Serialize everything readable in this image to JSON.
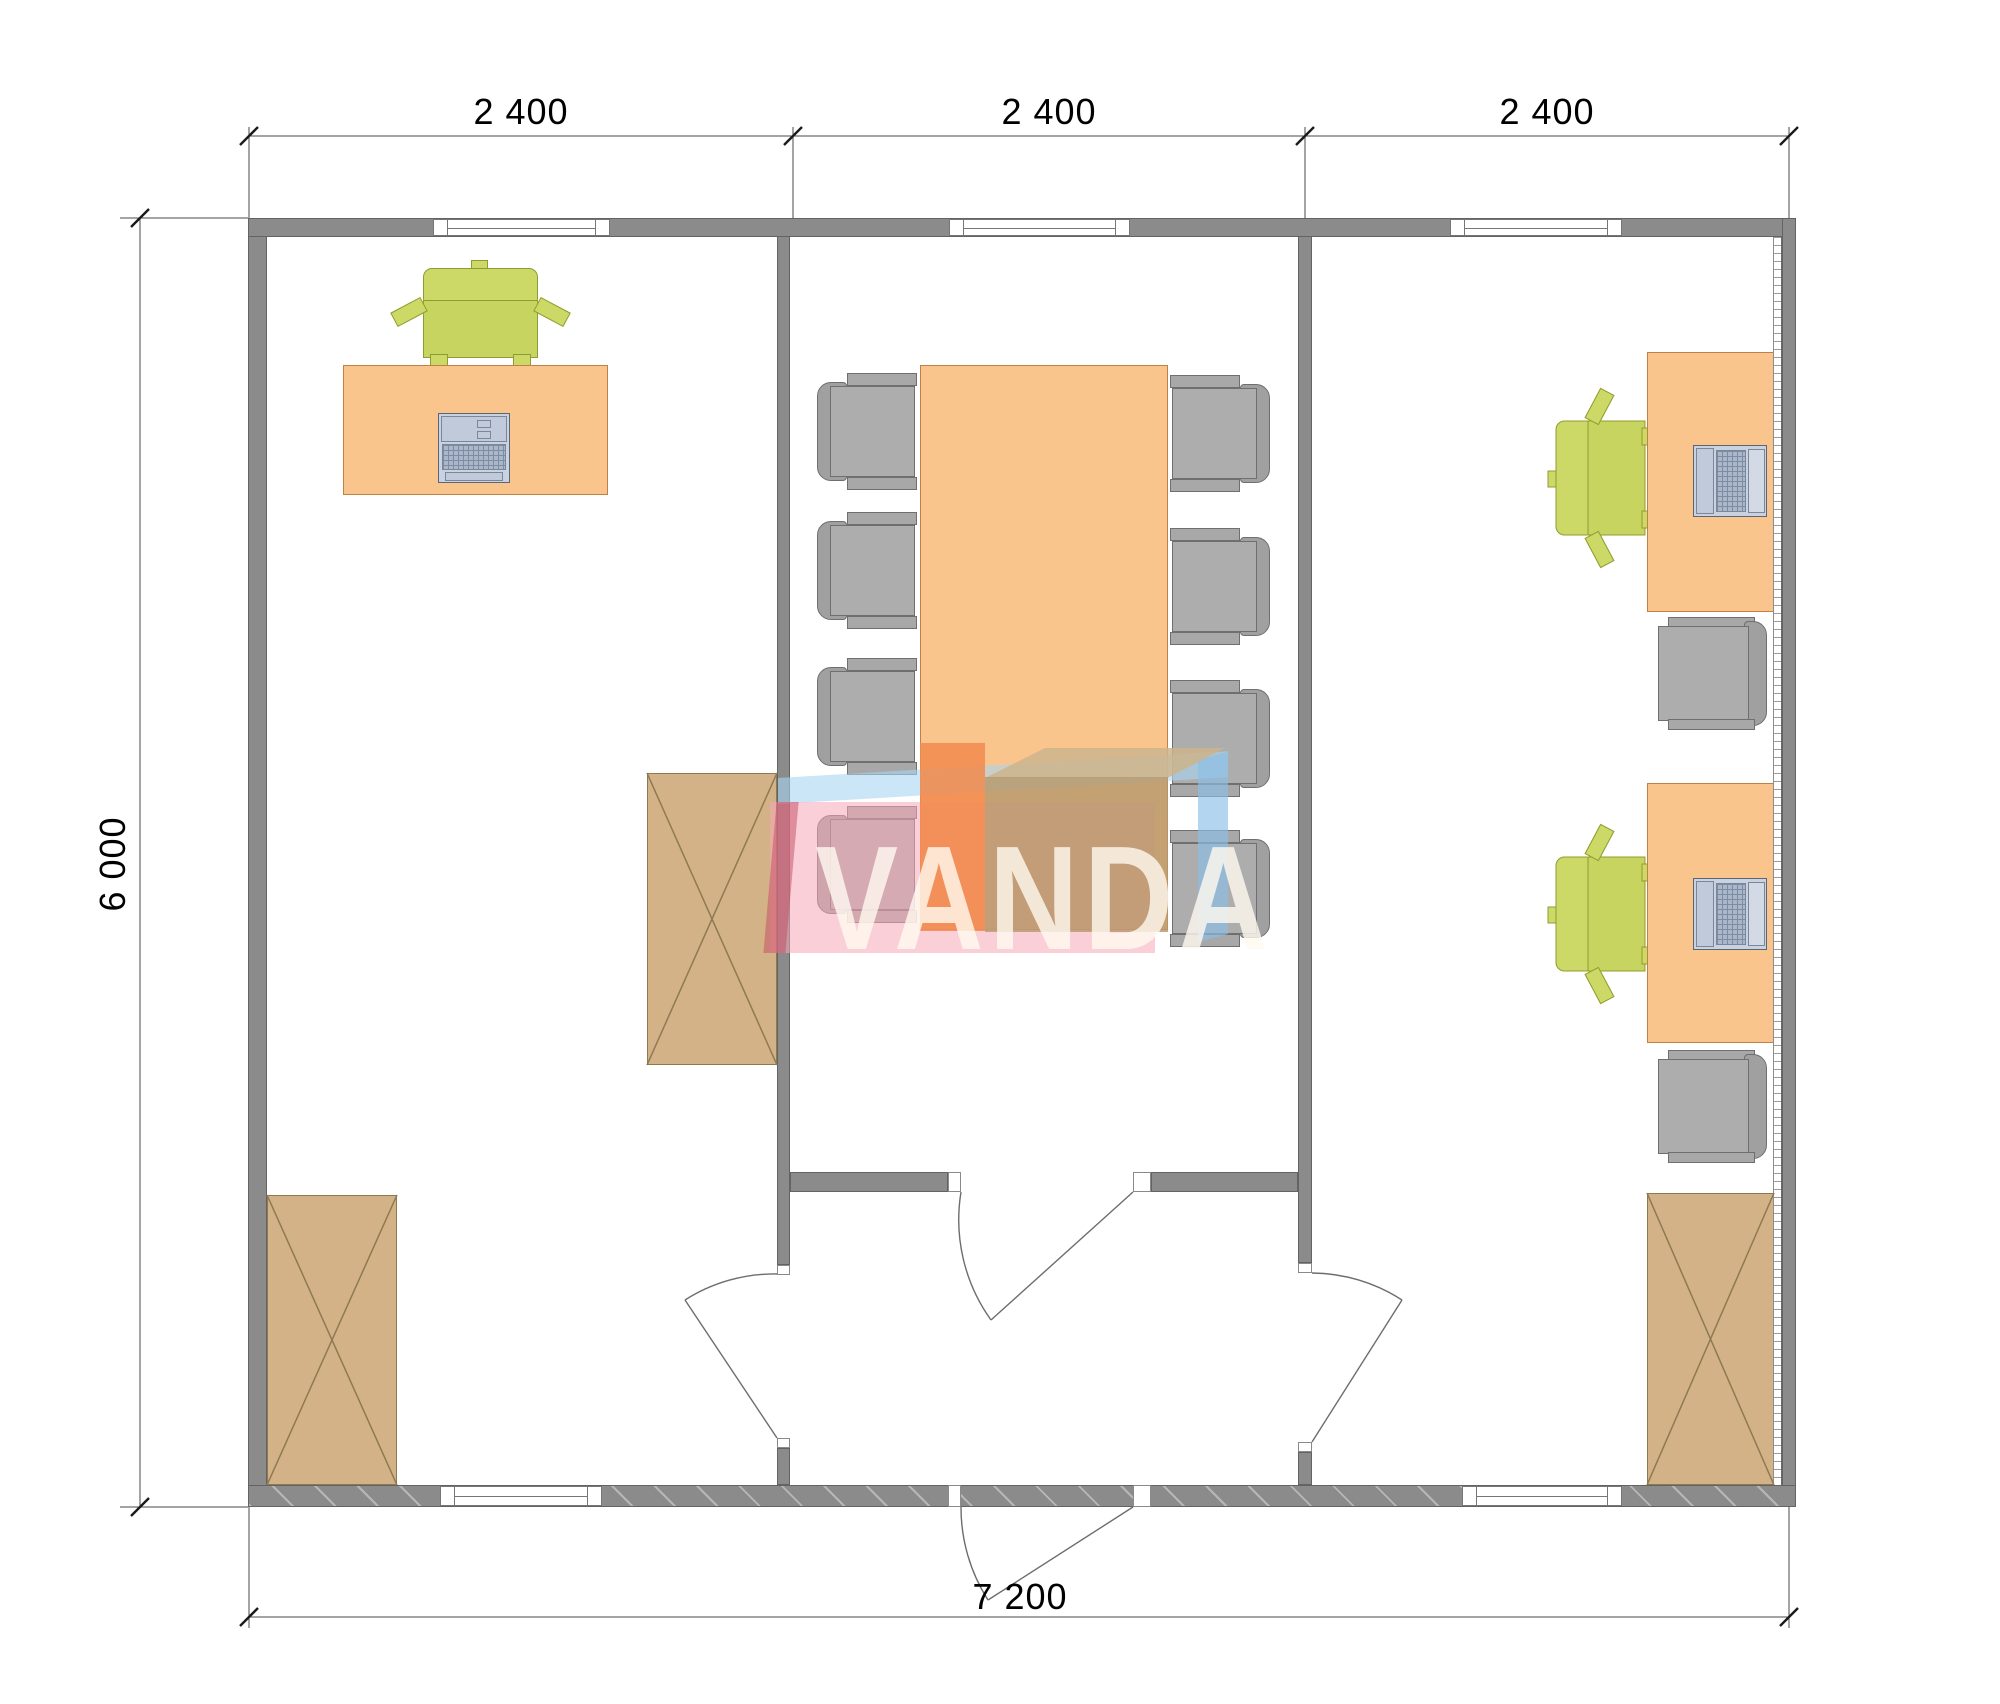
{
  "dimensions": {
    "top_segments": [
      "2 400",
      "2 400",
      "2 400"
    ],
    "left_total": "6 000",
    "bottom_total": "7 200"
  },
  "watermark": {
    "text": "VANDA"
  },
  "colors": {
    "wall": "#8b8b8b",
    "desk": "#fac58c",
    "cabinet": "#d3b287",
    "chair_green": "#ccd966",
    "chair_gray": "#a8a8a8",
    "device": "#c9d2e0",
    "watermark_pink": "#f6a8b8",
    "watermark_orange": "#f28a4d",
    "watermark_blue": "#a8d6f0",
    "watermark_tan": "#b5976b"
  },
  "rooms": {
    "left_office": {
      "furniture": [
        "desk",
        "office-chair",
        "keyboard",
        "storage-cabinet",
        "storage-cabinet"
      ]
    },
    "meeting_room": {
      "furniture": [
        "conference-table",
        "meeting-chair",
        "meeting-chair",
        "meeting-chair",
        "meeting-chair",
        "meeting-chair",
        "meeting-chair",
        "meeting-chair",
        "meeting-chair"
      ]
    },
    "right_office": {
      "furniture": [
        "desk",
        "desk",
        "office-chair",
        "office-chair",
        "laptop",
        "laptop",
        "side-chair",
        "side-chair",
        "storage-cabinet"
      ]
    }
  },
  "openings": {
    "windows_top": 3,
    "windows_bottom": 2,
    "interior_doors": 3,
    "entrance_doors": 1
  }
}
